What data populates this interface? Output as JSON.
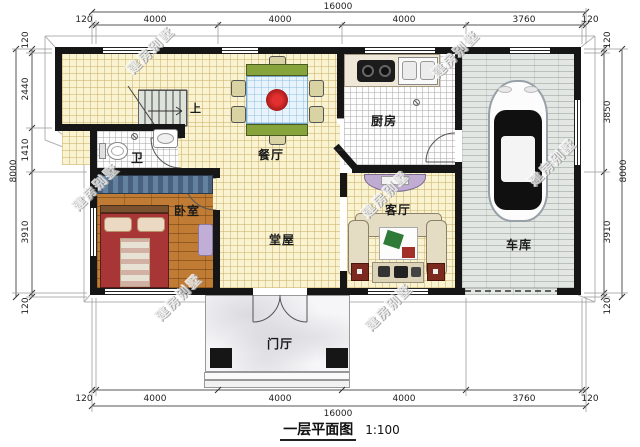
{
  "title": {
    "name": "一层平面图",
    "scale": "1:100"
  },
  "watermark": "建房别墅",
  "rooms": {
    "kitchen": "厨房",
    "dining": "餐厅",
    "bath": "卫",
    "bedroom": "卧室",
    "hall": "堂屋",
    "living": "客厅",
    "garage": "车库",
    "porch": "门厅",
    "stairs_up": "上"
  },
  "dimensions": {
    "top": {
      "total": "16000",
      "segments": [
        "120",
        "4000",
        "4000",
        "4000",
        "3760",
        "120"
      ]
    },
    "bottom": {
      "total": "16000",
      "segments": [
        "120",
        "4000",
        "4000",
        "4000",
        "3760",
        "120"
      ]
    },
    "left": {
      "total": "8000",
      "segments": [
        "120",
        "2440",
        "1410",
        "3910",
        "120"
      ]
    },
    "right": {
      "total": "8000",
      "segments": [
        "120",
        "3850",
        "3910",
        "120"
      ]
    }
  },
  "colors": {
    "wall": "#161616",
    "floor_main": "#faf3d2",
    "floor_wood": "#c07c34",
    "accent_table": "#86a33c",
    "accent_bed": "#a93636",
    "accent_furniture": "#c0abd2"
  }
}
